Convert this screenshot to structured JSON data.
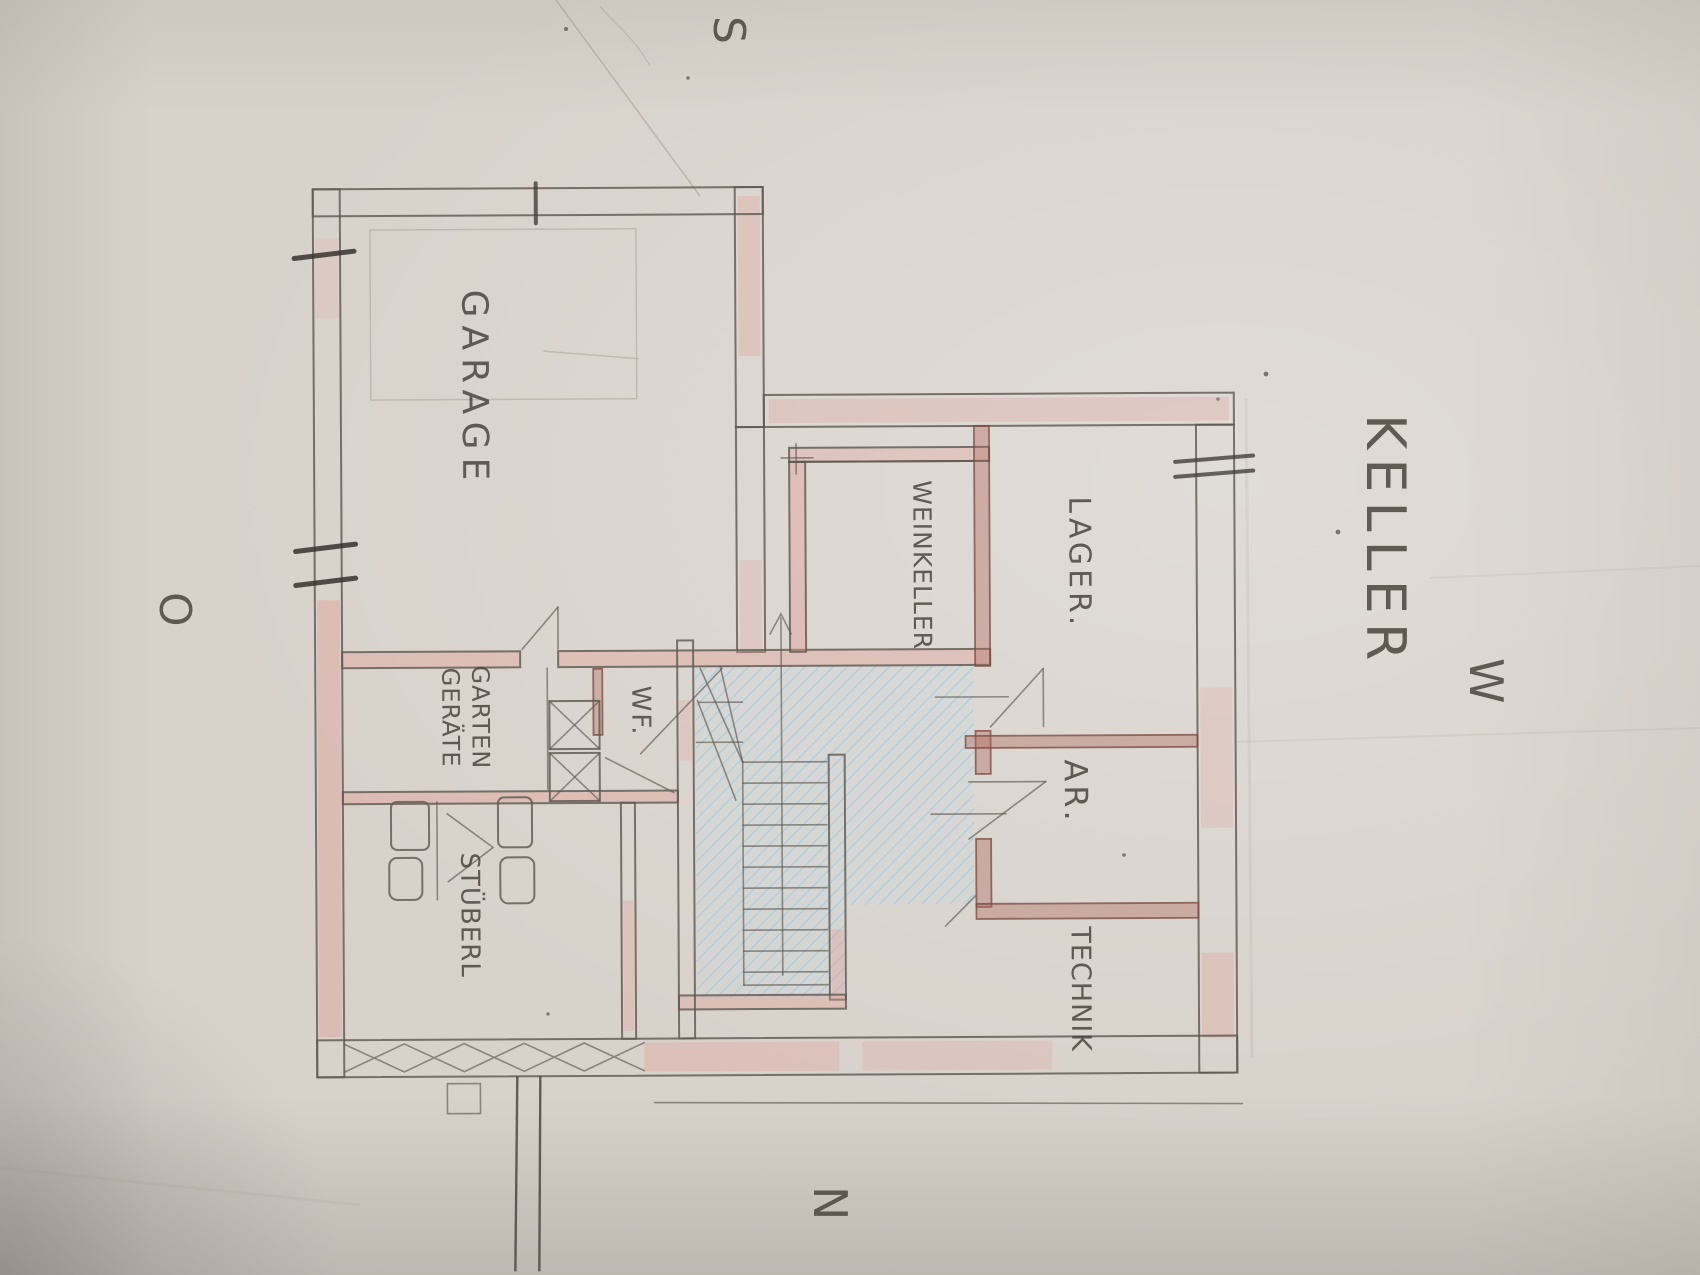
{
  "title": "KELLER",
  "compass": {
    "south": "S",
    "east": "O",
    "west": "W",
    "north": "N"
  },
  "rooms": {
    "garage": "GARAGE",
    "weinkeller": "WEINKELLER",
    "lager": "LAGER.",
    "abstellraum": "AR.",
    "technik": "TECHNIK",
    "gartengeraete_line1": "GARTEN",
    "gartengeraete_line2": "GERÄTE",
    "stueberl": "STÜBERL",
    "wf": "WF."
  },
  "colors": {
    "paper": "#d8d2cb",
    "pencil": "#5f5952",
    "ink": "#4c463f",
    "wall_pink": "#e29b92",
    "wall_red": "#b06a5e",
    "stair_blue": "#afc8d6"
  }
}
